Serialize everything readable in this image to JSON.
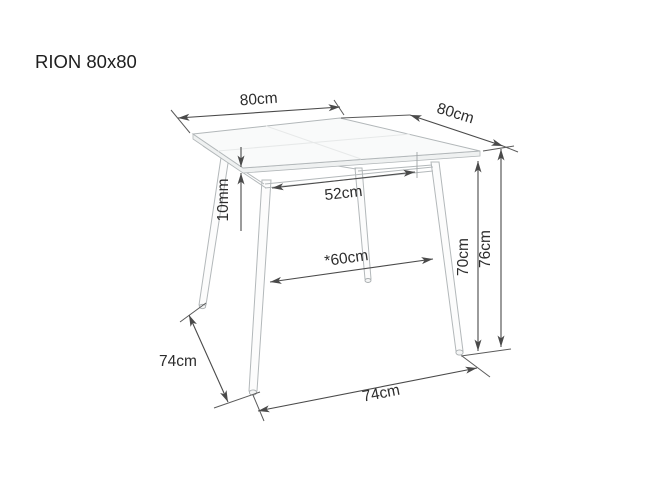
{
  "title": "RION 80x80",
  "labels": {
    "top_width": "80cm",
    "top_depth": "80cm",
    "thickness": "10mm",
    "clearance_width": "52cm",
    "clearance_depth": "*60cm",
    "underside_height": "70cm",
    "total_height": "76cm",
    "base_side": "74cm",
    "base_front": "74cm"
  }
}
